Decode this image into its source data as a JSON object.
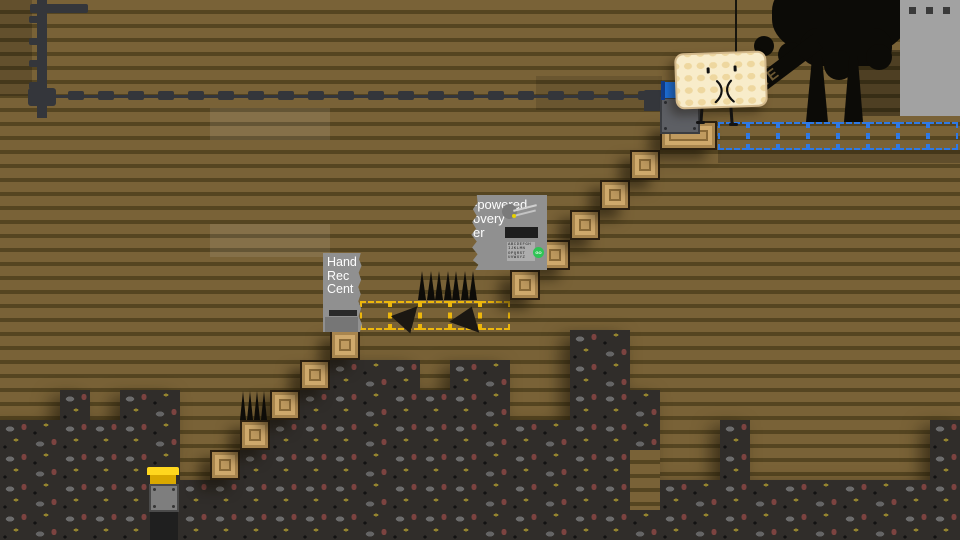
{
  "scene": {
    "width": 960,
    "height": 540,
    "colors": {
      "wood_light": "#796237",
      "wood_dark": "#554521",
      "dirt": "#302d2a",
      "crate": "#bf9a5f",
      "ghost_yellow": "#edb70c",
      "ghost_blue": "#2e79e6",
      "rope_dark": "#34363b",
      "tree_black": "#0c0b07",
      "panel_gray": "#a2a2a2",
      "flag_blue": "#1d74e4",
      "button_yellow": "#ffd71e",
      "machine_gray": "#909090",
      "go_green": "#2fc455",
      "waffle_cream": "#f8ecca"
    },
    "shade_patches": [
      {
        "x": 0,
        "y": 0,
        "w": 32,
        "h": 96,
        "color": "rgba(0,0,0,0.18)"
      },
      {
        "x": 536,
        "y": 76,
        "w": 126,
        "h": 34,
        "color": "rgba(0,0,0,0.12)"
      },
      {
        "x": 210,
        "y": 108,
        "w": 120,
        "h": 32,
        "color": "rgba(255,255,255,0.09)"
      },
      {
        "x": 210,
        "y": 224,
        "w": 120,
        "h": 33,
        "color": "rgba(255,255,255,0.09)"
      },
      {
        "x": 858,
        "y": 50,
        "w": 42,
        "h": 66,
        "color": "rgba(0,0,0,0.35)"
      },
      {
        "x": 718,
        "y": 150,
        "w": 242,
        "h": 13,
        "color": "rgba(0,0,0,0.20)"
      }
    ],
    "dirt_rects": [
      [
        0,
        420,
        60,
        120
      ],
      [
        60,
        390,
        30,
        150
      ],
      [
        90,
        420,
        30,
        120
      ],
      [
        120,
        390,
        60,
        150
      ],
      [
        180,
        480,
        30,
        60
      ],
      [
        210,
        480,
        30,
        60
      ],
      [
        240,
        450,
        30,
        90
      ],
      [
        270,
        420,
        30,
        120
      ],
      [
        300,
        390,
        30,
        150
      ],
      [
        330,
        360,
        90,
        180
      ],
      [
        420,
        390,
        30,
        150
      ],
      [
        450,
        360,
        60,
        180
      ],
      [
        510,
        420,
        60,
        120
      ],
      [
        570,
        330,
        60,
        210
      ],
      [
        600,
        390,
        60,
        150
      ],
      [
        660,
        480,
        270,
        60
      ],
      [
        720,
        420,
        30,
        120
      ],
      [
        930,
        420,
        30,
        120
      ]
    ],
    "wood_notches": [
      [
        630,
        450,
        30,
        60
      ]
    ],
    "crates": [
      [
        210,
        450,
        30,
        30
      ],
      [
        240,
        420,
        30,
        30
      ],
      [
        270,
        390,
        30,
        30
      ],
      [
        300,
        360,
        30,
        30
      ],
      [
        330,
        330,
        30,
        30
      ],
      [
        510,
        270,
        30,
        30
      ],
      [
        540,
        240,
        30,
        30
      ],
      [
        570,
        210,
        30,
        30
      ],
      [
        600,
        180,
        30,
        30
      ],
      [
        630,
        150,
        30,
        30
      ],
      [
        660,
        121,
        57,
        29
      ]
    ],
    "spike_strips": [
      {
        "x": 418,
        "y": 271,
        "count": 7,
        "w": 60,
        "h": 29
      },
      {
        "x": 240,
        "y": 391,
        "count": 4,
        "w": 28,
        "h": 29
      }
    ],
    "fallen_spikes": [
      {
        "x": 396,
        "y": 303,
        "w": 26,
        "h": 25,
        "rot": 42
      },
      {
        "x": 452,
        "y": 306,
        "w": 32,
        "h": 22,
        "rot": 20
      }
    ],
    "ghost_rows": [
      {
        "x": 360,
        "y": 301,
        "cells": 5,
        "cw": 30,
        "ch": 29,
        "color": "#edb70c"
      },
      {
        "x": 718,
        "y": 122,
        "cells": 8,
        "cw": 30,
        "ch": 28,
        "color": "#2e79e6"
      }
    ],
    "rope": {
      "x": 38,
      "y": 91,
      "line_y": 95,
      "end_x": 656,
      "period": 30,
      "dash_w": 16,
      "dash_h": 9
    },
    "pole": {
      "x": 37,
      "y": 0,
      "w": 10,
      "h": 118,
      "topbar": [
        30,
        4,
        58,
        9
      ],
      "nubs_y": [
        16,
        38,
        60,
        82
      ],
      "cross": [
        28,
        88,
        28,
        18
      ],
      "end_conn": [
        644,
        90,
        18,
        13
      ]
    }
  },
  "tree": {
    "branch_text": "EE"
  },
  "machine_big": {
    "line1": "-powered",
    "line2": "overy",
    "line3": "er",
    "keypad_rows": [
      "ABCDEFGH",
      "IJKLMN",
      "OPQRST",
      "UVWXYZ"
    ],
    "go_label": "GO"
  },
  "machine_small": {
    "line1": "Hand",
    "line2": "Rec",
    "line3": "Cent"
  }
}
